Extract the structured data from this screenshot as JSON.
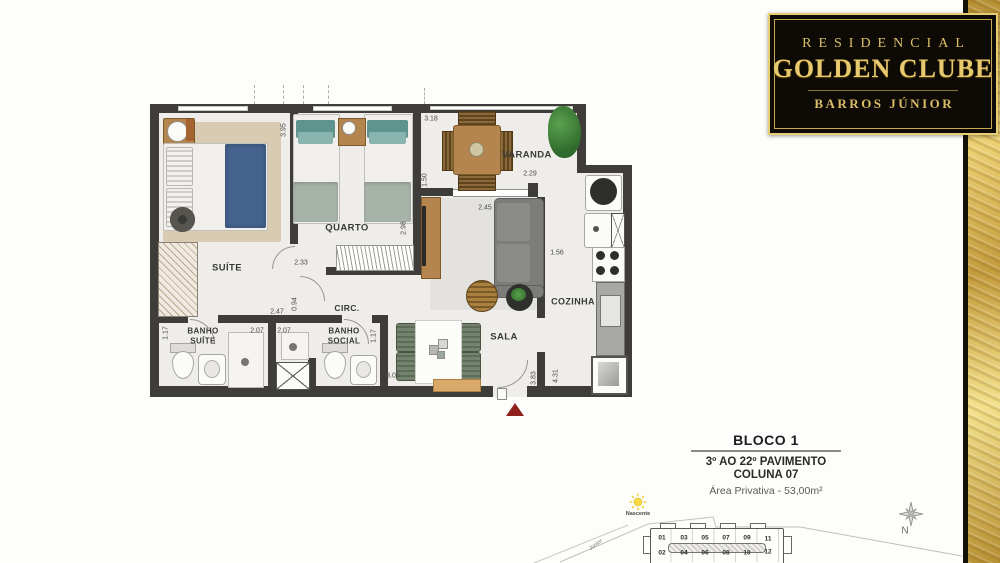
{
  "logo": {
    "line1": "RESIDENCIAL",
    "line2": "GOLDEN CLUBE",
    "line3": "BARROS JÚNIOR"
  },
  "floor_plan": {
    "rooms": {
      "suite": "SUÍTE",
      "quarto": "QUARTO",
      "varanda": "VARANDA",
      "sala": "SALA",
      "cozinha": "COZINHA",
      "circ": "CIRC.",
      "banho_suite": "BANHO\nSUÍTE",
      "banho_social": "BANHO\nSOCIAL"
    },
    "dims": {
      "d395": "3.95",
      "d318": "3.18",
      "d150": "1.50",
      "d229": "2.29",
      "d245": "2.45",
      "d298": "2.98",
      "d233": "2.33",
      "d247": "2.47",
      "d094": "0.94",
      "d207a": "2.07",
      "d207b": "2.07",
      "d117a": "1.17",
      "d117b": "1.17",
      "d156": "1.56",
      "d306": "3.06",
      "d383": "3.83",
      "d431": "4.31"
    }
  },
  "info_block": {
    "title": "BLOCO 1",
    "pavimento": "3º AO 22º PAVIMENTO",
    "coluna": "COLUNA 07",
    "area": "Área Privativa - 53,00m²"
  },
  "site_plan": {
    "sun_label": "Nascente",
    "north_label": "N",
    "street_label": "Júnior",
    "units_top": [
      "01",
      "03",
      "05",
      "07",
      "09",
      "11"
    ],
    "units_bottom": [
      "02",
      "04",
      "06",
      "08",
      "10",
      "12"
    ]
  },
  "colors": {
    "wall": "#3f3d3a",
    "floor": "#efedea",
    "plaque": "#0e0a05",
    "gold": "#d4af37",
    "red": "#8e211c",
    "bedblue": "#45638e",
    "teal": "#5f948e",
    "wood": "#b5854f",
    "sofa": "#7c7c7a",
    "counter": "#a8a8a4",
    "rug": "#d9cab2"
  }
}
